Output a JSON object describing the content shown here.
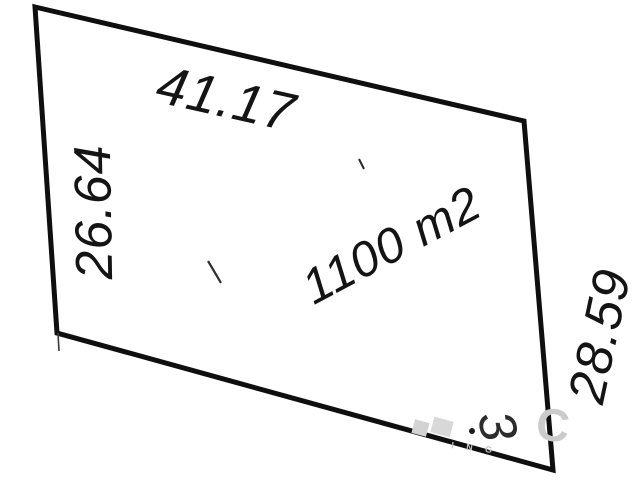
{
  "canvas": {
    "width": 640,
    "height": 480,
    "background": "#ffffff"
  },
  "parcel": {
    "area_label": "1100 m2",
    "dimensions": {
      "top": "41.17",
      "left": "26.64",
      "right": "28.59",
      "bottom_obscured_digit": "3"
    },
    "outline_color": "#0f0f0f",
    "text_color": "#141414"
  },
  "watermark": {
    "letter": "C",
    "tagline": "I N G",
    "color": "#c9c9c9"
  }
}
